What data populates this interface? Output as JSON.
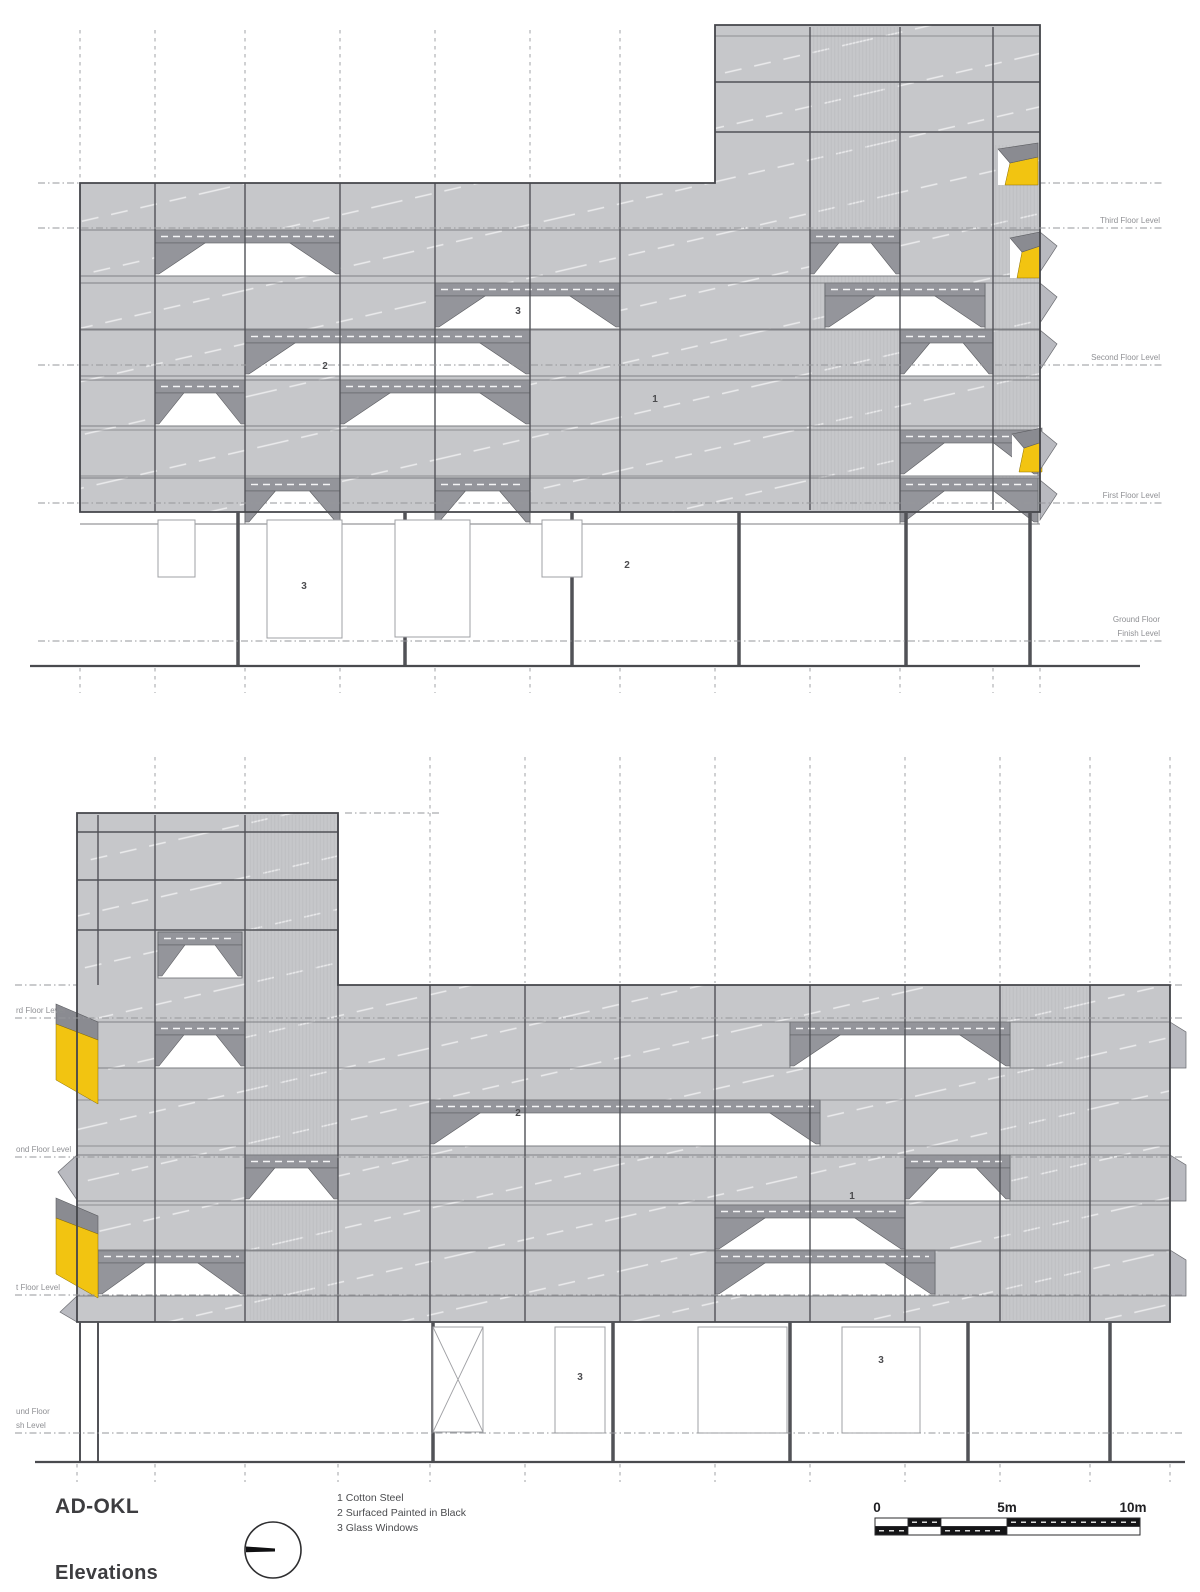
{
  "title_block": {
    "project": "AD-OKL",
    "sheet": "Elevations"
  },
  "legend": {
    "items": [
      "1 Cotton Steel",
      "2 Surfaced Painted in Black",
      "3 Glass Windows"
    ]
  },
  "scale_bar": {
    "labels": [
      "0",
      "5m",
      "10m"
    ]
  },
  "elevations": {
    "top": {
      "floor_labels": [
        "Third Floor Level",
        "Second Floor Level",
        "First Floor Level",
        "Ground Floor",
        "Finish Level"
      ],
      "annotations": [
        "3",
        "2",
        "1",
        "3",
        "2"
      ]
    },
    "bottom": {
      "floor_labels": [
        "rd Floor Level",
        "ond Floor Level",
        "t Floor Level",
        "und Floor",
        "sh Level"
      ],
      "annotations": [
        "2",
        "1",
        "3",
        "3"
      ]
    }
  },
  "colors": {
    "facade_gray": "#c6c7ca",
    "fold_gray": "#94959b",
    "accent_yellow": "#f2c411",
    "outline": "#44454a",
    "ground_line": "#4a4b4f",
    "label_gray": "#8f9094",
    "text_dark": "#3d3d40"
  }
}
